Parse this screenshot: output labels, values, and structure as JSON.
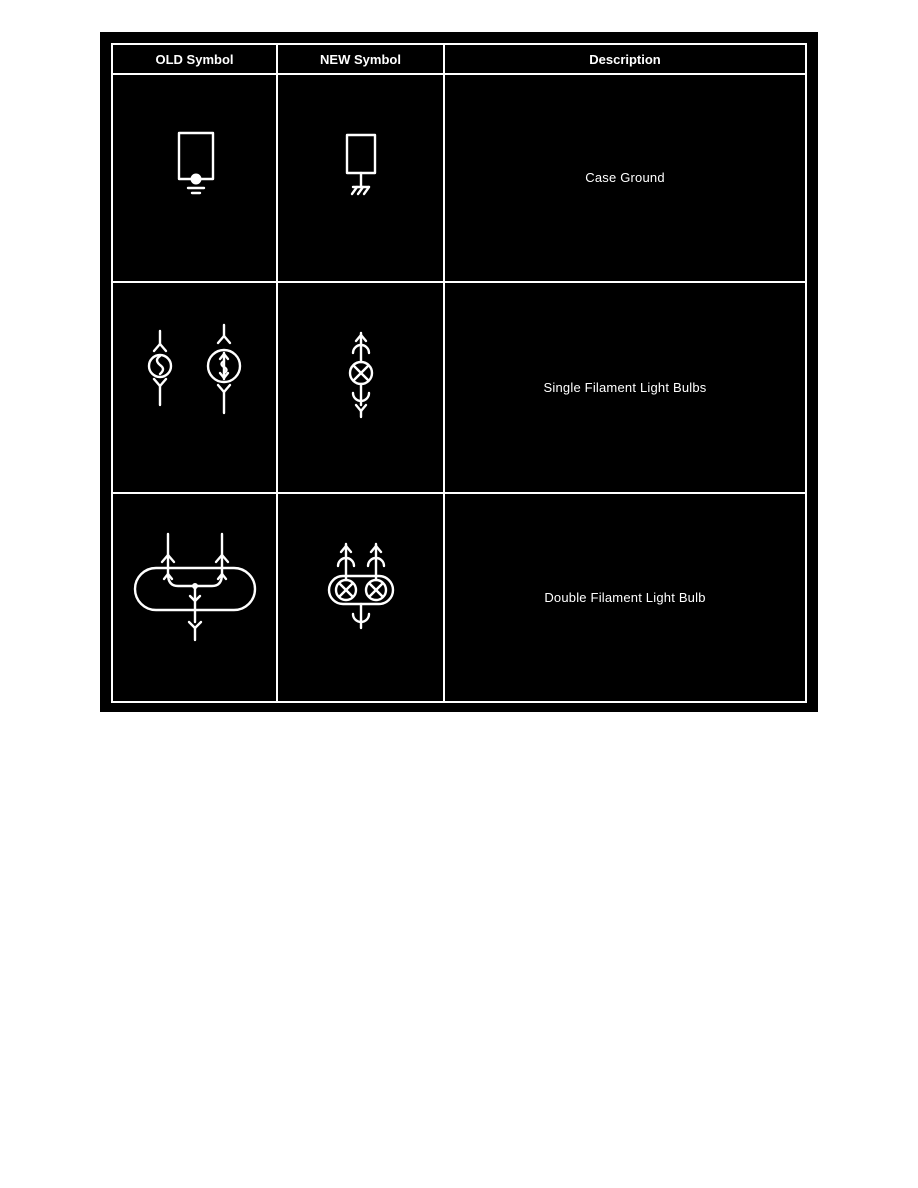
{
  "figure": {
    "name": "wiring-diagram-symbol-legend",
    "colors": {
      "page_background": "#ffffff",
      "figure_background": "#000000",
      "table_border": "#ffffff",
      "text": "#ffffff"
    },
    "table": {
      "headers": [
        {
          "label": "OLD Symbol"
        },
        {
          "label": "NEW Symbol"
        },
        {
          "label": "Description"
        }
      ],
      "rows": [
        {
          "description": "Case Ground",
          "old_symbol": "case-ground-old-icon",
          "new_symbol": "case-ground-new-icon"
        },
        {
          "description": "Single Filament Light Bulbs",
          "old_symbol": "single-filament-bulb-old-icons",
          "new_symbol": "single-filament-bulb-new-icon"
        },
        {
          "description": "Double Filament Light Bulb",
          "old_symbol": "double-filament-bulb-old-icon",
          "new_symbol": "double-filament-bulb-new-icon"
        }
      ]
    }
  }
}
